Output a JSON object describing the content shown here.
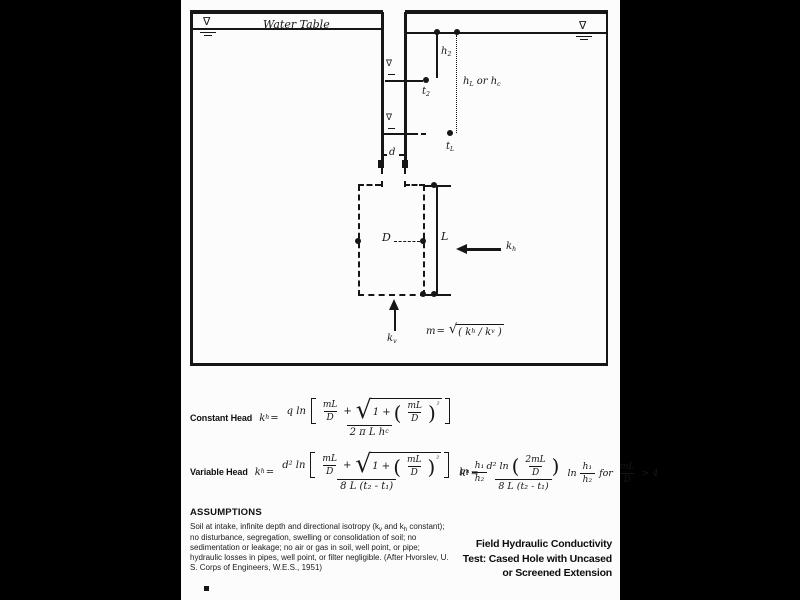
{
  "colors": {
    "bg": "#000000",
    "paper": "#fcfcfc",
    "ink": "#161616"
  },
  "icons": {
    "nabla": "∇",
    "radical": "√"
  },
  "diagram": {
    "water_table": "Water Table",
    "h2": {
      "b": "h",
      "s": "2"
    },
    "t2": {
      "b": "t",
      "s": "2"
    },
    "hlhc": {
      "p1": "h",
      "s1": "L",
      "p2": " or h",
      "s2": "c"
    },
    "tl": {
      "b": "t",
      "s": "L"
    },
    "d": "d",
    "Dia": "D",
    "L": "L",
    "kh": {
      "b": "k",
      "s": "h"
    },
    "kv": {
      "b": "k",
      "s": "v"
    },
    "m": {
      "lhs": "m",
      "eq": "=",
      "open": "(",
      "kb": "k",
      "ks": "h",
      "slash": "/",
      "kb2": "k",
      "ks2": "v",
      "close": ")"
    }
  },
  "eq": {
    "constant_label": "Constant Head",
    "variable_label": "Variable Head",
    "k": "k",
    "k_sub": "h",
    "equals": "=",
    "c_num_pre": "q ln",
    "v_num_pre": "d² ln",
    "mL": "mL",
    "D": "D",
    "plus": "+",
    "one_plus": "1 +",
    "lp": "(",
    "rp": ")",
    "sup2": "²",
    "c_den_pre": "2 π L h",
    "c_den_sub": "c",
    "v_den": "8 L (t₂ - t₁)",
    "ln": "ln",
    "h1": "h₁",
    "h2": "h₂",
    "two_mL": "2mL",
    "for": "for",
    "gt4": "> 4"
  },
  "assumptions": {
    "header": "ASSUMPTIONS",
    "p1": "Soil at intake, infinite depth and directional isotropy (k",
    "s1": "v",
    "p2": " and k",
    "s2": "h",
    "p3": " constant); no disturbance, segregation, swelling or consolidation of soil; no sedimentation or leakage; no air or gas in soil, well point, or pipe; hydraulic losses in pipes, well point, or filter negligible. (After Hvorslev, U. S. Corps of Engineers, W.E.S., 1951)"
  },
  "title": {
    "line1": "Field Hydraulic Conductivity",
    "line2": "Test: Cased Hole with Uncased",
    "line3": "or Screened Extension"
  }
}
